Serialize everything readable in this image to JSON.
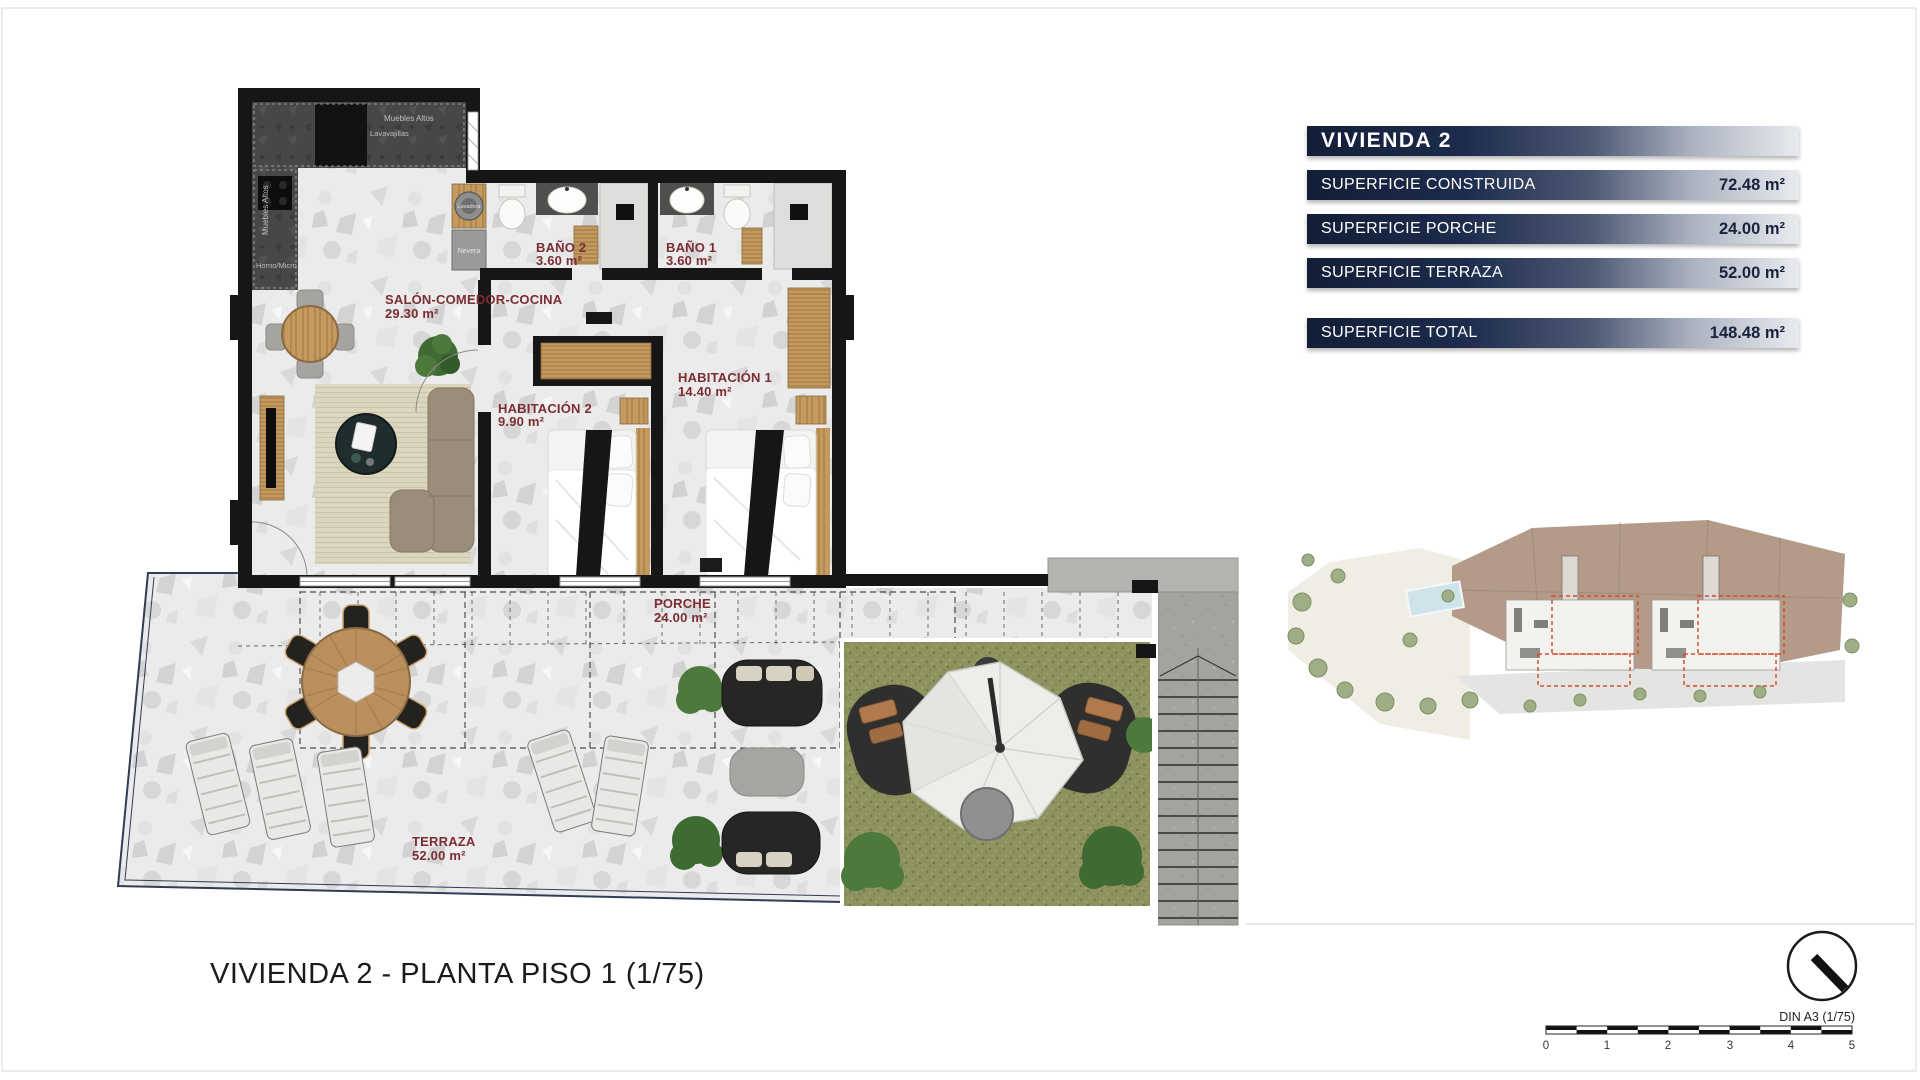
{
  "plan": {
    "label_color": "#7b2d33",
    "region_labels": {
      "salon": {
        "name": "SALÓN-COMEDOR-COCINA",
        "area": "29.30 m²"
      },
      "bano2": {
        "name": "BAÑO 2",
        "area": "3.60 m²"
      },
      "bano1": {
        "name": "BAÑO 1",
        "area": "3.60 m²"
      },
      "hab2": {
        "name": "HABITACIÓN 2",
        "area": "9.90 m²"
      },
      "hab1": {
        "name": "HABITACIÓN 1",
        "area": "14.40 m²"
      },
      "porche": {
        "name": "PORCHE",
        "area": "24.00 m²"
      },
      "terraza": {
        "name": "TERRAZA",
        "area": "52.00 m²"
      }
    },
    "kitchen_labels": {
      "upper_cabinets_top": "Muebles Altos",
      "dishwasher": "Lavavajillas",
      "upper_cabinets_left": "Muebles Altos",
      "oven_micro": "Horno/Micro",
      "washer": "Lavadora",
      "fridge": "Nevera"
    }
  },
  "summary_table": {
    "title": "VIVIENDA 2",
    "rows": [
      {
        "label": "SUPERFICIE CONSTRUIDA",
        "value": "72.48 m²"
      },
      {
        "label": "SUPERFICIE PORCHE",
        "value": "24.00 m²"
      },
      {
        "label": "SUPERFICIE TERRAZA",
        "value": "52.00 m²"
      }
    ],
    "total": {
      "label": "SUPERFICIE TOTAL",
      "value": "148.48 m²"
    },
    "colors": {
      "bar_dark": "#131e37",
      "bar_light": "#e9ebef",
      "label_text": "#ffffff",
      "value_text": "#17223c"
    }
  },
  "footer": {
    "drawing_title": "VIVIENDA 2 - PLANTA PISO 1 (1/75)"
  },
  "scale_block": {
    "sheet_note": "DIN A3 (1/75)",
    "ticks": [
      "0",
      "1",
      "2",
      "3",
      "4",
      "5"
    ]
  }
}
